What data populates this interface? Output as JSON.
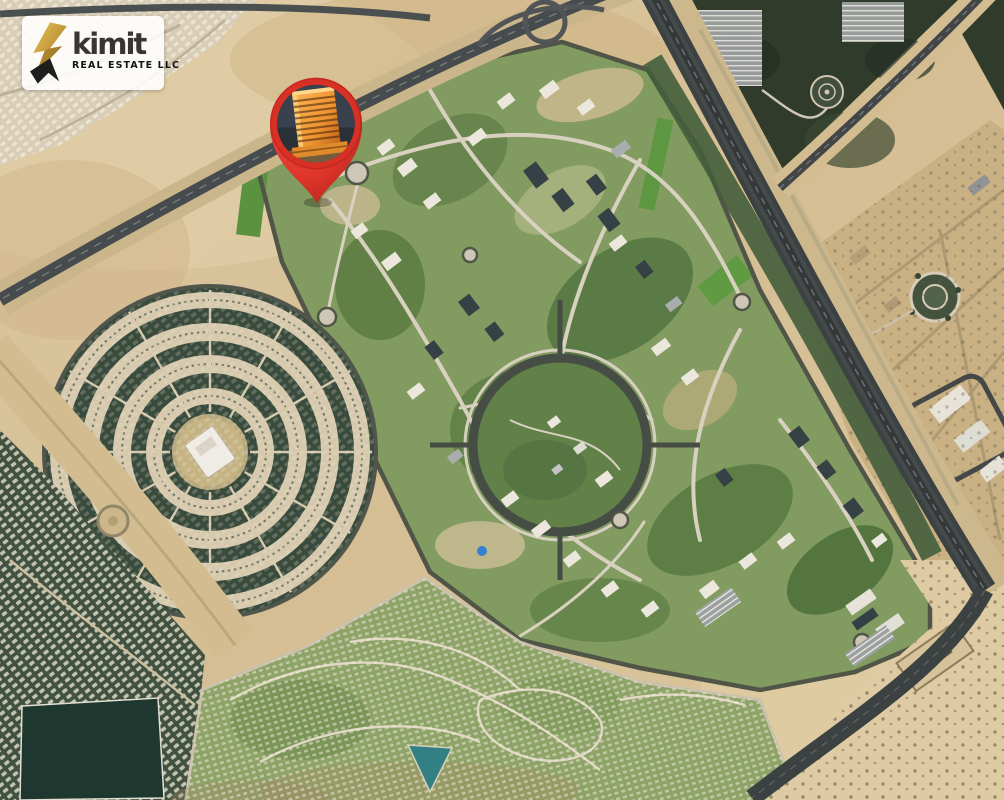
{
  "logo": {
    "brand": "kimit",
    "subtitle": "REAL ESTATE LLC"
  },
  "map": {
    "view": "satellite",
    "marker": {
      "icon": "location-pin-icon",
      "photo_subject": "orange-lit high-rise building"
    }
  },
  "colors": {
    "pin_red": "#d93025",
    "pin_red_light": "#f05043",
    "logo_gold": "#c49a3a",
    "logo_gold_dark": "#8f6d1f",
    "logo_text": "#383634",
    "sand": "#d7c29a",
    "development_green": "#7d9a5f",
    "vegetation_dark": "#273528",
    "road_dark": "#3a4145",
    "road_light": "#d9d3c3",
    "pond_teal": "#2a7d85",
    "building_orange": "#f7a945"
  }
}
